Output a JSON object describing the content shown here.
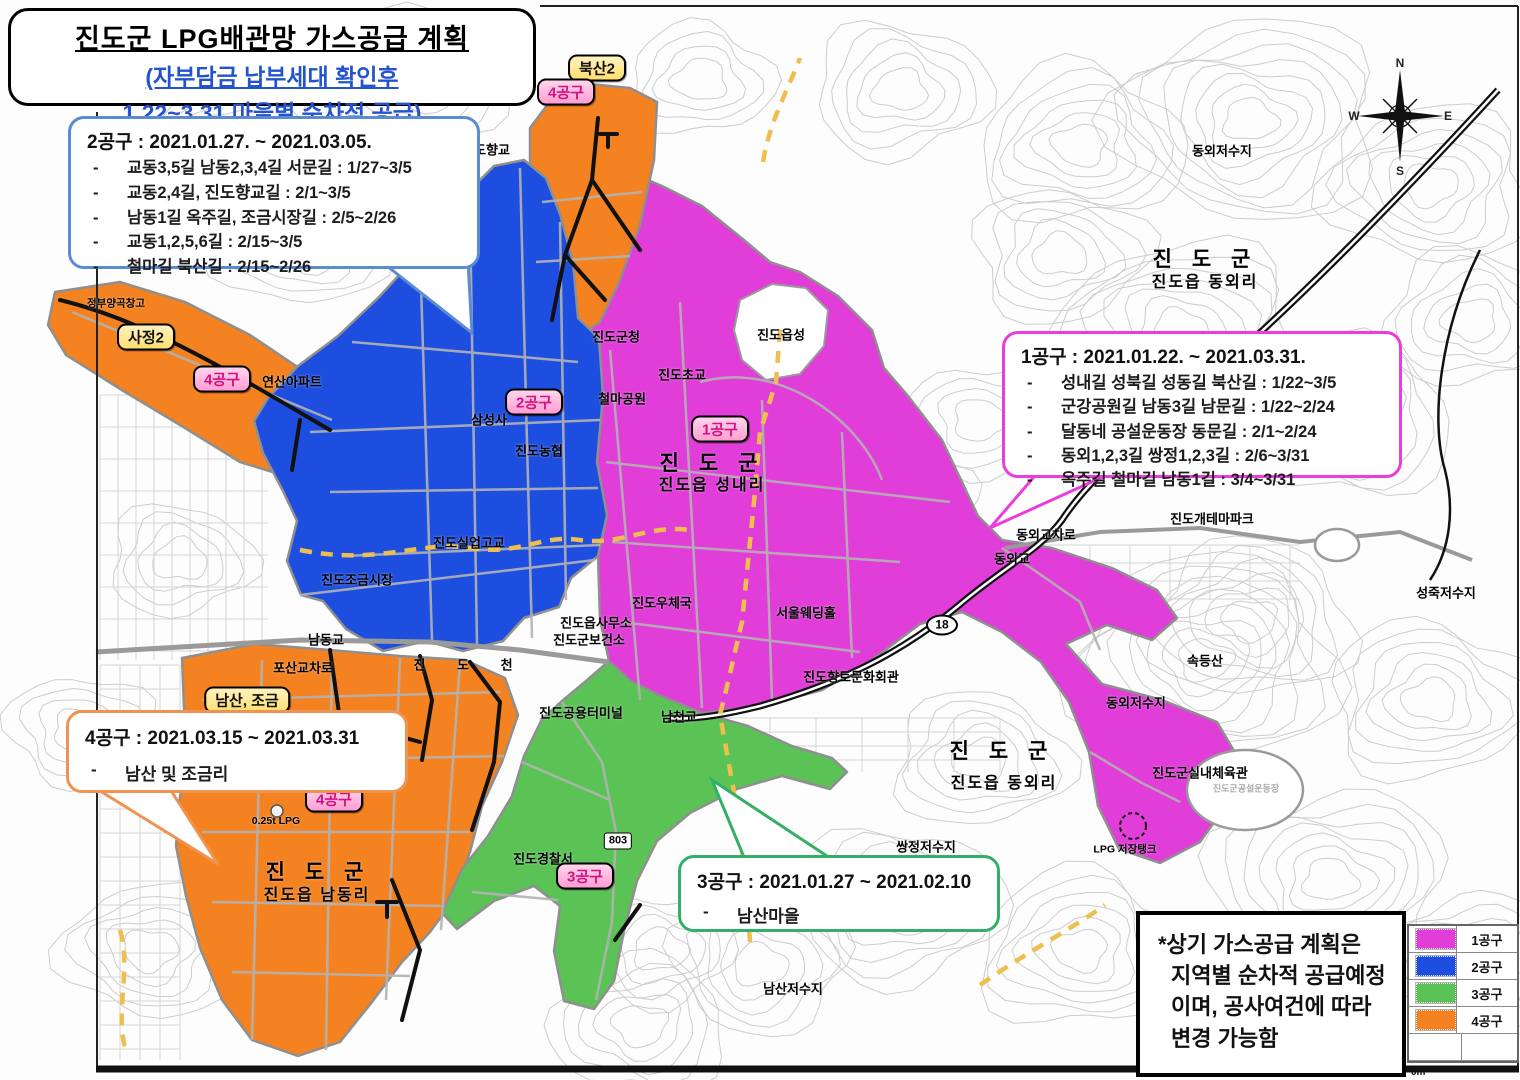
{
  "title_box": {
    "line1": "진도군 LPG배관망 가스공급 계획",
    "line2": "(자부담금 납부세대 확인후",
    "line3": "1.22~3.31 마을별 순차적 공급)"
  },
  "callouts": {
    "gongu2": {
      "heading": "2공구 : 2021.01.27. ~ 2021.03.05.",
      "items": [
        "교동3,5길 남동2,3,4길 서문길 : 1/27~3/5",
        "교동2,4길, 진도향교길 : 2/1~3/5",
        "남동1길 옥주길, 조금시장길 : 2/5~2/26",
        "교동1,2,5,6길 : 2/15~3/5",
        "철마길 북산길 : 2/15~2/26"
      ]
    },
    "gongu1": {
      "heading": "1공구 : 2021.01.22. ~ 2021.03.31.",
      "items": [
        "성내길 성북길 성동길 북산길 : 1/22~3/5",
        "군강공원길 남동3길 남문길 : 1/22~2/24",
        "달동네 공설운동장 동문길 : 2/1~2/24",
        "동외1,2,3길 쌍정1,2,3길 : 2/6~3/31",
        "옥주길 철마길 남동1길 : 3/4~3/31"
      ]
    },
    "gongu4": {
      "heading": "4공구 : 2021.03.15 ~ 2021.03.31",
      "items": [
        "남산 및 조금리"
      ]
    },
    "gongu3": {
      "heading": "3공구 : 2021.01.27 ~ 2021.02.10",
      "items": [
        "남산마을"
      ]
    }
  },
  "note_box": {
    "lines": [
      "*상기 가스공급 계획은",
      "지역별 순차적 공급예정",
      "이며, 공사여건에 따라",
      "변경 가능함"
    ]
  },
  "legend": {
    "items": [
      {
        "label": "1공구",
        "color": "#e13dd8"
      },
      {
        "label": "2공구",
        "color": "#1e4ee0"
      },
      {
        "label": "3공구",
        "color": "#5bc355"
      },
      {
        "label": "4공구",
        "color": "#f58220"
      }
    ],
    "scale_label": "0m"
  },
  "compass": {
    "n": "N",
    "e": "E",
    "s": "S",
    "w": "W"
  },
  "colors": {
    "zone1_magenta": "#e13dd8",
    "zone2_blue": "#1e4ee0",
    "zone3_green": "#5bc355",
    "zone4_orange": "#f58220",
    "subtitle_blue": "#2353cf",
    "badge_pink_text": "#d4117e"
  },
  "map": {
    "badges": [
      {
        "text": "북산2",
        "x": 597,
        "y": 68,
        "style": "yellow"
      },
      {
        "text": "4공구",
        "x": 566,
        "y": 92,
        "style": "pink"
      },
      {
        "text": "사정2",
        "x": 146,
        "y": 337,
        "style": "yellow"
      },
      {
        "text": "4공구",
        "x": 222,
        "y": 379,
        "style": "pink"
      },
      {
        "text": "남산, 조금",
        "x": 247,
        "y": 700,
        "style": "yellow"
      },
      {
        "text": "4공구",
        "x": 334,
        "y": 799,
        "style": "pink"
      },
      {
        "text": "2공구",
        "x": 534,
        "y": 402,
        "style": "pink"
      },
      {
        "text": "1공구",
        "x": 720,
        "y": 429,
        "style": "pink"
      },
      {
        "text": "3공구",
        "x": 585,
        "y": 876,
        "style": "pink"
      }
    ],
    "shields": [
      {
        "text": "18",
        "x": 942,
        "y": 625,
        "shape": "ellipse"
      },
      {
        "text": "803",
        "x": 618,
        "y": 841,
        "shape": "rect"
      }
    ],
    "labels": [
      {
        "text": "진도향교",
        "x": 486,
        "y": 149,
        "cls": "md"
      },
      {
        "text": "정부양곡창고",
        "x": 116,
        "y": 303,
        "cls": "sm"
      },
      {
        "text": "연산아파트",
        "x": 292,
        "y": 381,
        "cls": "md"
      },
      {
        "text": "진도군청",
        "x": 616,
        "y": 336,
        "cls": "md"
      },
      {
        "text": "진도초교",
        "x": 682,
        "y": 374,
        "cls": "md"
      },
      {
        "text": "진도읍성",
        "x": 781,
        "y": 334,
        "cls": "md"
      },
      {
        "text": "철마공원",
        "x": 622,
        "y": 398,
        "cls": "md"
      },
      {
        "text": "삼성사",
        "x": 489,
        "y": 419,
        "cls": "md"
      },
      {
        "text": "진도농협",
        "x": 539,
        "y": 450,
        "cls": "md"
      },
      {
        "text": "진도실업고교",
        "x": 469,
        "y": 542,
        "cls": "md"
      },
      {
        "text": "진도조금시장",
        "x": 357,
        "y": 579,
        "cls": "md"
      },
      {
        "text": "진도우체국",
        "x": 662,
        "y": 602,
        "cls": "md"
      },
      {
        "text": "서울웨딩홀",
        "x": 806,
        "y": 612,
        "cls": "md"
      },
      {
        "text": "진도읍사무소",
        "x": 596,
        "y": 622,
        "cls": "md"
      },
      {
        "text": "진도군보건소",
        "x": 589,
        "y": 639,
        "cls": "md"
      },
      {
        "text": "남동교",
        "x": 326,
        "y": 639,
        "cls": "md"
      },
      {
        "text": "포산교차로",
        "x": 303,
        "y": 667,
        "cls": "md"
      },
      {
        "text": "남천교",
        "x": 679,
        "y": 716,
        "cls": "md"
      },
      {
        "text": "진도공용터미널",
        "x": 581,
        "y": 712,
        "cls": "md"
      },
      {
        "text": "진도향토문화회관",
        "x": 851,
        "y": 676,
        "cls": "md"
      },
      {
        "text": "동외교차로",
        "x": 1046,
        "y": 534,
        "cls": "md"
      },
      {
        "text": "동외교",
        "x": 1012,
        "y": 558,
        "cls": "md"
      },
      {
        "text": "진도개테마파크",
        "x": 1212,
        "y": 518,
        "cls": "md"
      },
      {
        "text": "성죽저수지",
        "x": 1446,
        "y": 592,
        "cls": "md"
      },
      {
        "text": "속등산",
        "x": 1205,
        "y": 660,
        "cls": "md"
      },
      {
        "text": "동외저수지",
        "x": 1136,
        "y": 702,
        "cls": "md"
      },
      {
        "text": "동외저수지",
        "x": 1222,
        "y": 150,
        "cls": "md"
      },
      {
        "text": "쌍정저수지",
        "x": 926,
        "y": 846,
        "cls": "md"
      },
      {
        "text": "남산저수지",
        "x": 793,
        "y": 988,
        "cls": "md"
      },
      {
        "text": "진도경찰서",
        "x": 543,
        "y": 858,
        "cls": "md"
      },
      {
        "text": "진도군실내체육관",
        "x": 1200,
        "y": 772,
        "cls": "md"
      },
      {
        "text": "LPG 저장탱크",
        "x": 1125,
        "y": 849,
        "cls": "sm"
      },
      {
        "text": "0.25t LPG",
        "x": 276,
        "y": 821,
        "cls": "sm"
      },
      {
        "text": "진도군공설운동장",
        "x": 1246,
        "y": 788,
        "cls": "xs"
      },
      {
        "text": "진 도 군",
        "x": 712,
        "y": 462,
        "cls": "lg"
      },
      {
        "text": "진도읍 성내리",
        "x": 712,
        "y": 483,
        "cls": "mdb"
      },
      {
        "text": "진 도 군",
        "x": 1205,
        "y": 258,
        "cls": "lg"
      },
      {
        "text": "진도읍 동외리",
        "x": 1205,
        "y": 280,
        "cls": "mdb"
      },
      {
        "text": "진 도 군",
        "x": 1002,
        "y": 750,
        "cls": "lg"
      },
      {
        "text": "진도읍 동외리",
        "x": 1004,
        "y": 781,
        "cls": "mdb"
      },
      {
        "text": "진 도 군",
        "x": 318,
        "y": 871,
        "cls": "lg"
      },
      {
        "text": "진도읍 남동리",
        "x": 317,
        "y": 893,
        "cls": "mdb"
      },
      {
        "text": "진 도 천",
        "x": 470,
        "y": 664,
        "cls": "sp"
      }
    ]
  }
}
